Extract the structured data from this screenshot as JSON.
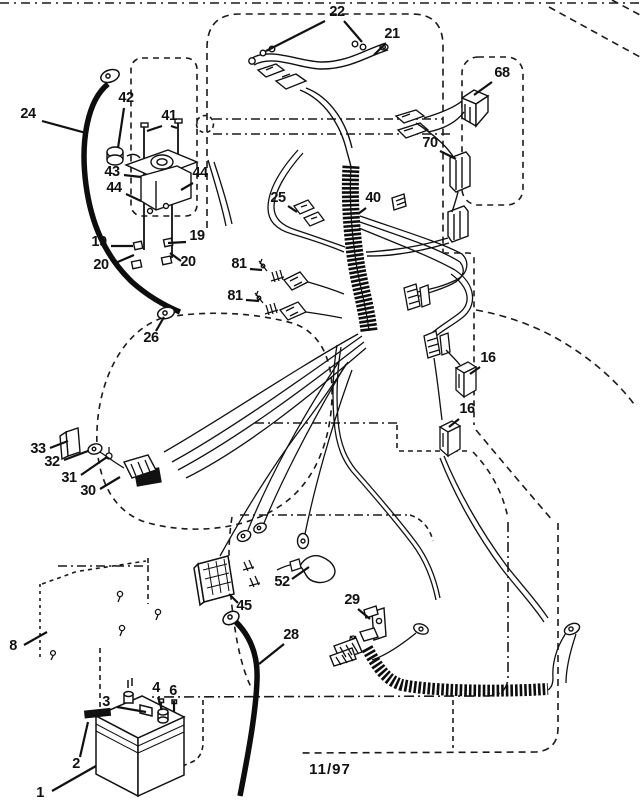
{
  "footer": {
    "date_code": "11/97"
  },
  "diagram": {
    "kind": "exploded wiring-harness parts diagram",
    "callouts": [
      {
        "label": "22",
        "x": 337,
        "y": 16,
        "leaders": [
          [
            325,
            21,
            266,
            51
          ],
          [
            344,
            21,
            362,
            42
          ]
        ]
      },
      {
        "label": "21",
        "x": 392,
        "y": 38,
        "leaders": [
          [
            385,
            44,
            374,
            55
          ]
        ]
      },
      {
        "label": "68",
        "x": 502,
        "y": 77,
        "leaders": [
          [
            492,
            82,
            474,
            95
          ]
        ]
      },
      {
        "label": "24",
        "x": 28,
        "y": 118,
        "leaders": [
          [
            42,
            121,
            86,
            133
          ]
        ]
      },
      {
        "label": "42",
        "x": 126,
        "y": 102,
        "leaders": [
          [
            124,
            108,
            118,
            148
          ]
        ]
      },
      {
        "label": "41",
        "x": 169,
        "y": 120,
        "leaders": [
          [
            162,
            126,
            147,
            131
          ],
          [
            171,
            126,
            177,
            128
          ]
        ]
      },
      {
        "label": "70",
        "x": 430,
        "y": 147,
        "leaders": [
          [
            440,
            151,
            456,
            159
          ]
        ]
      },
      {
        "label": "43",
        "x": 112,
        "y": 176,
        "leaders": [
          [
            124,
            175,
            141,
            177
          ]
        ]
      },
      {
        "label": "44",
        "x": 114,
        "y": 192,
        "leaders": [
          [
            126,
            194,
            141,
            201
          ]
        ]
      },
      {
        "label": "44",
        "x": 200,
        "y": 177,
        "leaders": [
          [
            193,
            183,
            181,
            190
          ]
        ]
      },
      {
        "label": "25",
        "x": 278,
        "y": 202,
        "leaders": [
          [
            288,
            206,
            297,
            212
          ]
        ]
      },
      {
        "label": "40",
        "x": 373,
        "y": 202,
        "leaders": [
          [
            366,
            208,
            358,
            214
          ]
        ]
      },
      {
        "label": "19",
        "x": 99,
        "y": 246,
        "leaders": [
          [
            111,
            246,
            133,
            246
          ]
        ]
      },
      {
        "label": "19",
        "x": 197,
        "y": 240,
        "leaders": [
          [
            186,
            242,
            168,
            243
          ]
        ]
      },
      {
        "label": "20",
        "x": 101,
        "y": 269,
        "leaders": [
          [
            113,
            264,
            134,
            255
          ]
        ]
      },
      {
        "label": "20",
        "x": 188,
        "y": 266,
        "leaders": [
          [
            181,
            261,
            170,
            253
          ]
        ]
      },
      {
        "label": "81",
        "x": 239,
        "y": 268,
        "leaders": [
          [
            250,
            269,
            262,
            270
          ]
        ]
      },
      {
        "label": "81",
        "x": 235,
        "y": 300,
        "leaders": [
          [
            246,
            300,
            259,
            301
          ]
        ]
      },
      {
        "label": "26",
        "x": 151,
        "y": 342,
        "leaders": [
          [
            156,
            331,
            164,
            317
          ]
        ]
      },
      {
        "label": "16",
        "x": 488,
        "y": 362,
        "leaders": [
          [
            480,
            367,
            470,
            374
          ]
        ]
      },
      {
        "label": "16",
        "x": 467,
        "y": 413,
        "leaders": [
          [
            459,
            419,
            449,
            427
          ]
        ]
      },
      {
        "label": "33",
        "x": 38,
        "y": 453,
        "leaders": [
          [
            50,
            448,
            68,
            441
          ]
        ]
      },
      {
        "label": "32",
        "x": 52,
        "y": 466,
        "leaders": [
          [
            64,
            460,
            88,
            451
          ]
        ]
      },
      {
        "label": "31",
        "x": 69,
        "y": 482,
        "leaders": [
          [
            81,
            475,
            107,
            457
          ]
        ]
      },
      {
        "label": "30",
        "x": 88,
        "y": 495,
        "leaders": [
          [
            100,
            489,
            120,
            477
          ]
        ]
      },
      {
        "label": "52",
        "x": 282,
        "y": 586,
        "leaders": [
          [
            292,
            579,
            309,
            567
          ]
        ]
      },
      {
        "label": "45",
        "x": 244,
        "y": 610,
        "leaders": [
          [
            238,
            603,
            229,
            594
          ]
        ]
      },
      {
        "label": "29",
        "x": 352,
        "y": 604,
        "leaders": [
          [
            358,
            609,
            370,
            619
          ]
        ]
      },
      {
        "label": "8",
        "x": 13,
        "y": 650,
        "leaders": [
          [
            24,
            645,
            47,
            632
          ]
        ]
      },
      {
        "label": "28",
        "x": 291,
        "y": 639,
        "leaders": [
          [
            284,
            644,
            259,
            664
          ]
        ]
      },
      {
        "label": "3",
        "x": 106,
        "y": 706,
        "leaders": [
          [
            117,
            707,
            146,
            712
          ]
        ]
      },
      {
        "label": "4",
        "x": 156,
        "y": 692,
        "leaders": [
          [
            158,
            697,
            162,
            710
          ]
        ]
      },
      {
        "label": "6",
        "x": 173,
        "y": 695,
        "leaders": [
          [
            174,
            701,
            174,
            712
          ]
        ]
      },
      {
        "label": "2",
        "x": 76,
        "y": 768,
        "leaders": [
          [
            80,
            757,
            88,
            722
          ]
        ]
      },
      {
        "label": "1",
        "x": 40,
        "y": 797,
        "leaders": [
          [
            52,
            791,
            96,
            766
          ]
        ]
      }
    ]
  }
}
